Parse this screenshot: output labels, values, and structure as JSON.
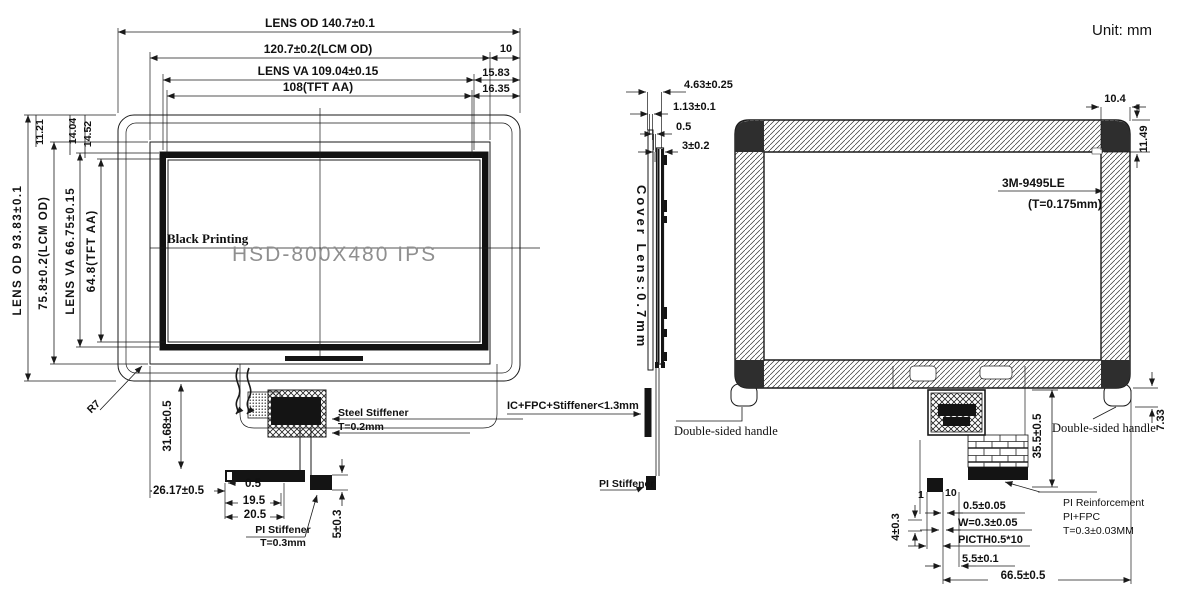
{
  "note": {
    "unit": "Unit: mm"
  },
  "front": {
    "od_h": "LENS OD 140.7±0.1",
    "lcm_h": "120.7±0.2(LCM OD)",
    "off10": "10",
    "va_h": "LENS VA 109.04±0.15",
    "off1583": "15.83",
    "aa_h": "108(TFT AA)",
    "off1635": "16.35",
    "od_v": "LENS OD 93.83±0.1",
    "lcm_v": "75.8±0.2(LCM OD)",
    "va_v": "LENS VA 66.75±0.15",
    "aa_v": "64.8(TFT AA)",
    "d1121": "11.21",
    "d1404": "14.04",
    "d1452": "14.52",
    "r7": "R7",
    "black_printing": "Black Printing",
    "watermark": "HSD-800X480 IPS",
    "steel1": "Steel Stiffener",
    "steel2": "T=0.2mm",
    "d3168": "31.68±0.5",
    "d2617": "26.17±0.5",
    "d05": "0.5",
    "d195": "19.5",
    "d205": "20.5",
    "pi1": "PI Stiffener",
    "pi2": "T=0.3mm",
    "d5": "5±0.3"
  },
  "side": {
    "d463": "4.63±0.25",
    "d113": "1.13±0.1",
    "d05": "0.5",
    "d3": "3±0.2",
    "cover": "Cover Lens:0.7mm",
    "ic": "IC+FPC+Stiffener<1.3mm",
    "pi": "PI Stiffener",
    "handle": "Double-sided handle"
  },
  "back": {
    "d104": "10.4",
    "d1149": "11.49",
    "tape1": "3M-9495LE",
    "tape2": "(T=0.175mm)",
    "handle": "Double-sided handle",
    "d733": "7.33",
    "d355": "35.5±0.5",
    "d1": "1",
    "d10": "10",
    "d4": "4±0.3",
    "d0505": "0.5±0.05",
    "dw": "W=0.3±0.05",
    "dpitch": "PICTH0.5*10",
    "d55": "5.5±0.1",
    "d665": "66.5±0.5",
    "pir1": "PI Reinforcement",
    "pir2": "PI+FPC",
    "pir3": "T=0.3±0.03MM"
  },
  "colors": {
    "line": "#1a1a1a",
    "watermark": "#8f8f8f"
  }
}
